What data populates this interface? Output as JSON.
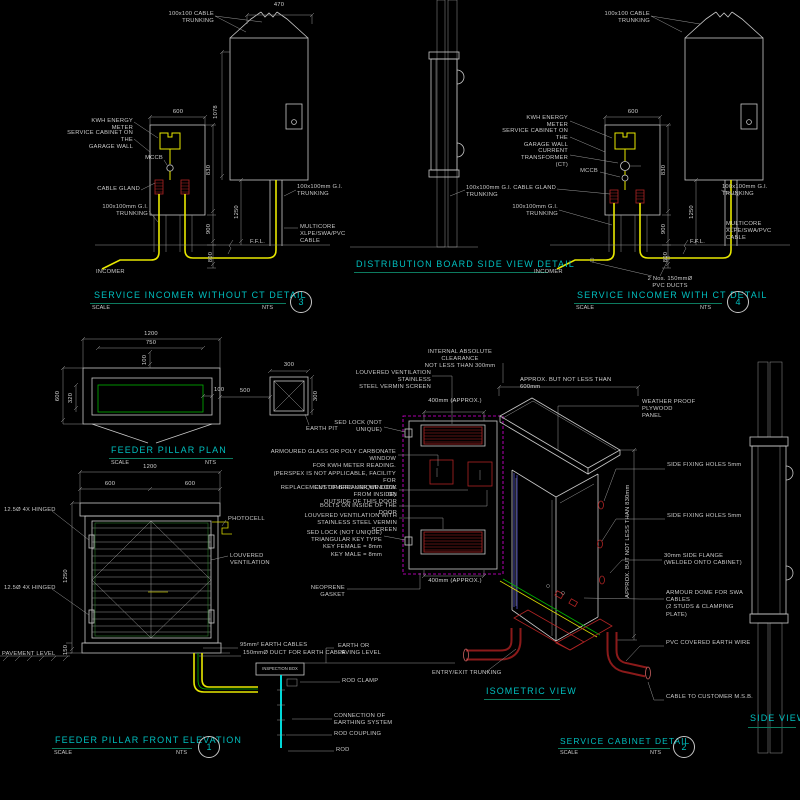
{
  "common": {
    "scale": "SCALE",
    "nts": "NTS",
    "gi_trunking": "100x100mm G.I.\nTRUNKING",
    "cable_trunking": "100x100 CABLE\nTRUNKING",
    "kwh": "KWH ENERGY METER",
    "cabinet_wall": "SERVICE CABINET ON THE\nGARAGE WALL",
    "mccb": "MCCB",
    "gland": "CABLE GLAND",
    "multicore": "MULTICORE XLPE/SWA/PVC\nCABLE",
    "ffl": "F.F.L.",
    "incomer": "INCOMER",
    "fixing_holes": "SIDE FIXING HOLES 5mm"
  },
  "views": {
    "a": {
      "title": "SERVICE INCOMER WITHOUT CT DETAIL",
      "no": "3",
      "dims": {
        "w470": "470",
        "h1078": "1078",
        "w600": "600",
        "h830": "830",
        "h900": "900",
        "h800": "800",
        "h1250": "1250"
      }
    },
    "b": {
      "title": "DISTRIBUTION BOARD SIDE VIEW DETAIL"
    },
    "c": {
      "title": "SERVICE INCOMER WITH CT DETAIL",
      "no": "4",
      "ct": "CURRENT TRANSFORMER\n(CT)",
      "pvc_ducts": "2 Nos. 150mmØ\nPVC DUCTS"
    },
    "plan": {
      "title": "FEEDER PILLAR PLAN",
      "earth_pit": "EARTH PIT",
      "dims": {
        "w1200": "1200",
        "w750": "750",
        "n100": "100",
        "h600": "600",
        "h320": "320",
        "gap500": "500",
        "p300": "300"
      }
    },
    "elev": {
      "title": "FEEDER PILLAR FRONT ELEVATION",
      "no": "1",
      "labels": {
        "hinged": "12.5Ø 4X HINGED",
        "photocell": "PHOTOCELL",
        "louvered": "LOUVERED VENTILATION",
        "pavement": "PAVEMENT LEVEL",
        "earth_cables": "95mm²  EARTH CABLES",
        "duct": "150mmØ DUCT FOR EARTH CABLE",
        "inspection": "INSPECTION BOX",
        "earth_paving": "EARTH OR\nPAVING LEVEL",
        "rod_clamp": "ROD CLAMP",
        "connection": "CONNECTION OF\nEARTHING SYSTEM",
        "rod_coupling": "ROD COUPLING",
        "rod": "ROD"
      },
      "dims": {
        "w1200": "1200",
        "w600": "600",
        "h1250": "1250",
        "h150": "150"
      }
    },
    "cab": {
      "labels": {
        "internal": "INTERNAL ABSOLUTE CLEARANCE\nNOT LESS THAN 300mm",
        "louver_top": "LOUVERED VENTILATION STAINLESS\nSTEEL VERMIN SCREEN",
        "sed1": "SED LOCK (NOT\nUNIQUE)",
        "window": "ARMOURED GLASS OR POLY CARBONATE WINDOW\nFOR KWH METER READING.\n(PERSPEX IS NOT APPLICABLE, FACILITY FOR\nREPLACEMENT OF BREAKER WINDOW FROM INSIDE)",
        "customers": "CUSTOMERS UNIQUE LOCK ON\nOUTSIDE OF THIS DOOR",
        "bolts": "BOLTS ON INSIDE OF THE DOOR",
        "louver_bot": "LOUVERED VENTILATION WITH\nSTAINLESS STEEL VERMIN SCREEN",
        "sed2": "SED LOCK (NOT UNIQUE)\nTRIANGULAR KEY TYPE\nKEY FEMALE = 8mm\nKEY MALE = 8mm",
        "neoprene": "NEOPRENE GASKET",
        "dim400": "400mm (APPROX.)"
      }
    },
    "iso": {
      "title": "ISOMETRIC VIEW",
      "labels": {
        "approx600": "APPROX. BUT NOT LESS THAN 600mm",
        "weather": "WEATHER PROOF PLYWOOD\nPANEL",
        "flange": "30mm SIDE FLANGE\n(WELDED ONTO CABINET)",
        "approx830": "APPROX. BUT NOT LESS THAN 830mm",
        "dome": "ARMOUR DOME FOR SWA CABLES\n(2 STUDS & CLAMPING PLATE)",
        "pvc_wire": "PVC COVERED EARTH WIRE",
        "msb": "CABLE TO CUSTOMER M.S.B.",
        "entry": "ENTRY/EXIT TRUNKING"
      }
    },
    "det2": {
      "title": "SERVICE CABINET DETAIL",
      "no": "2"
    },
    "side": {
      "title": "SIDE VIEW"
    }
  }
}
